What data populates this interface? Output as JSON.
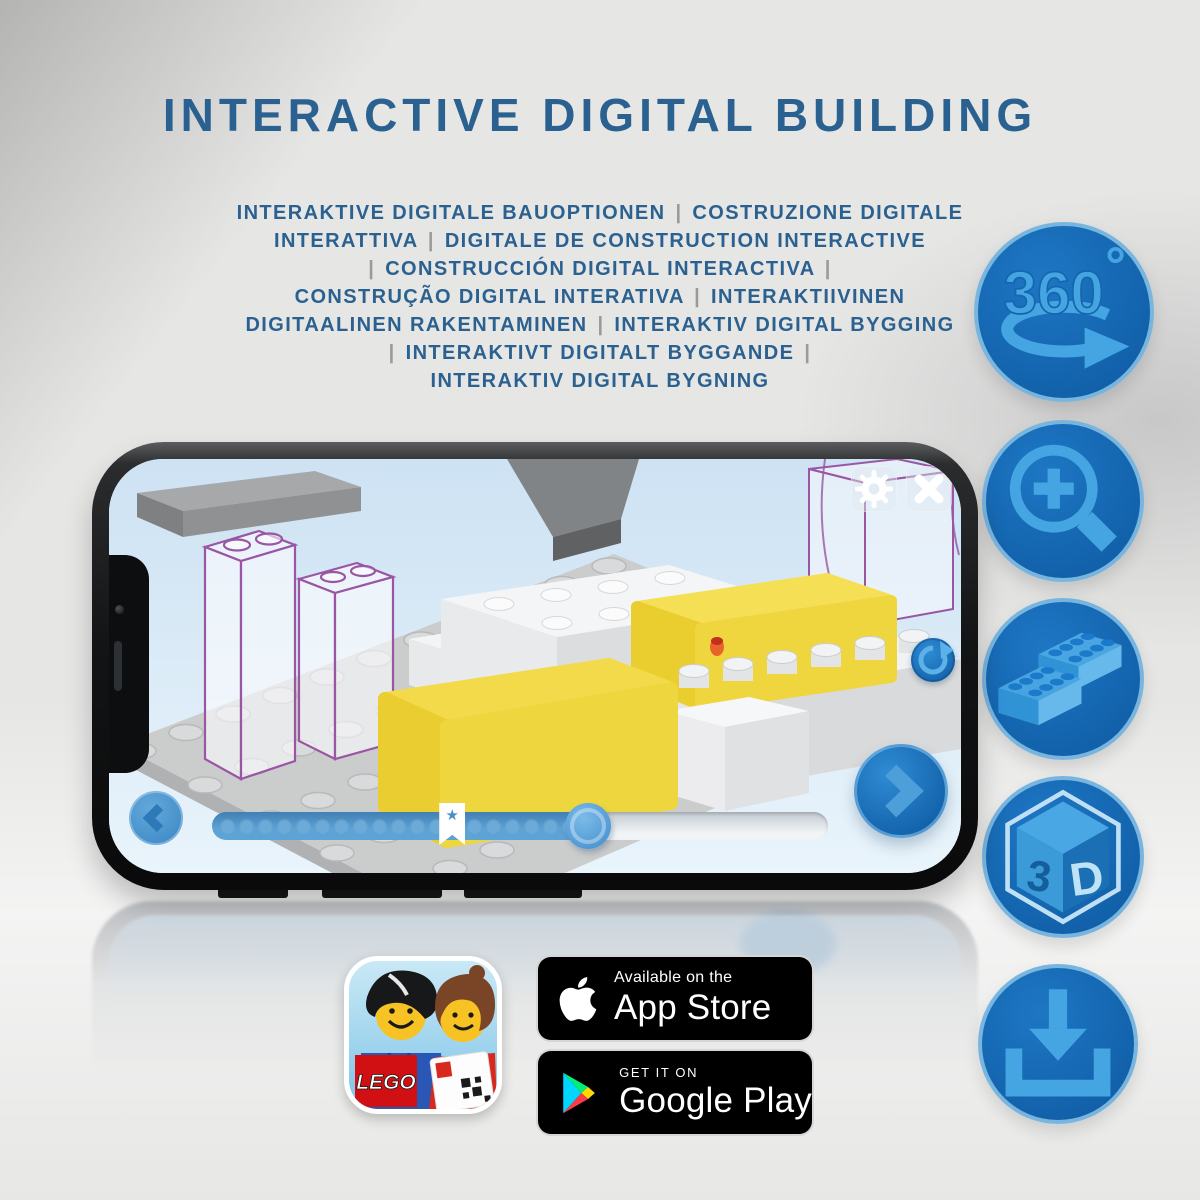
{
  "title": "INTERACTIVE DIGITAL BUILDING",
  "subtitle": {
    "lines": [
      "INTERAKTIVE DIGITALE BAUOPTIONEN | COSTRUZIONE DIGITALE",
      "INTERATTIVA | DIGITALE DE CONSTRUCTION INTERACTIVE",
      "| CONSTRUCCIÓN DIGITAL INTERACTIVA |",
      "CONSTRUÇÃO DIGITAL INTERATIVA | INTERAKTIIVINEN",
      "DIGITAALINEN RAKENTAMINEN | INTERAKTIV DIGITAL BYGGING",
      "| INTERAKTIVT DIGITALT BYGGANDE |",
      "INTERAKTIV DIGITAL BYGNING"
    ]
  },
  "features": [
    {
      "id": "rotate-360",
      "label": "360",
      "degree": "°"
    },
    {
      "id": "zoom-in",
      "label": ""
    },
    {
      "id": "brick-building",
      "label": ""
    },
    {
      "id": "view-3d",
      "front": "3",
      "side": "D"
    },
    {
      "id": "download",
      "label": ""
    }
  ],
  "phone": {
    "screen": {
      "progress": {
        "dots": 19,
        "percent": 61,
        "bookmark_percent": 39,
        "bookmark_icon": "★"
      }
    }
  },
  "badges": {
    "app_store": {
      "tagline": "Available on the",
      "store": "App Store"
    },
    "google_play": {
      "tagline": "GET IT ON",
      "store": "Google Play"
    }
  },
  "app_icon": {
    "name": "LEGO Building Instructions",
    "logo_text": "LEGO"
  },
  "colors": {
    "title_blue": "#2b6190",
    "icon_circle_blue": "#1565ae",
    "icon_glyph_blue": "#45a5e3",
    "screen_blue": "#d9e9f6",
    "brick_yellow": "#f3da4b",
    "ghost_purple": "#9a56a4"
  }
}
